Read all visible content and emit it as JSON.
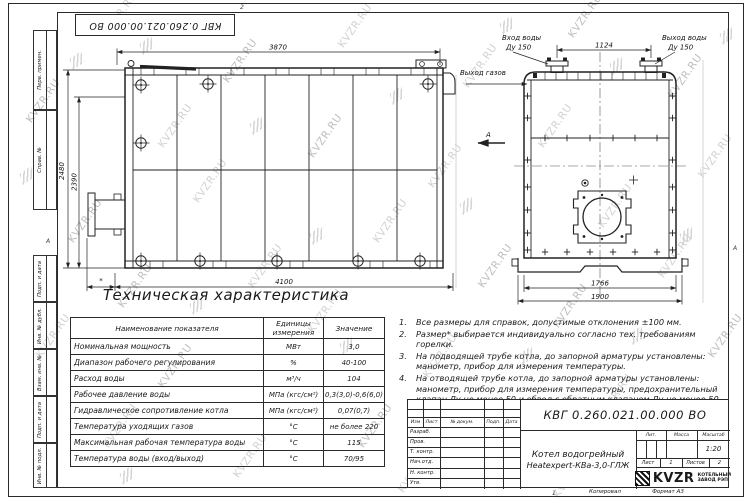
{
  "watermark": "KVZR.RU",
  "doc_number": "КВГ 0.260.021.00.000 ВО",
  "frame": {
    "left_labels": [
      "Перв. примен.",
      "Справ. №",
      "Подп. и дата",
      "Инв. № дубл.",
      "Взам. инв. №",
      "Подп. и дата",
      "Инв. № подл."
    ],
    "top_zone": "2",
    "bottom_zone": "1",
    "right_zone": "А",
    "left_zone": "А"
  },
  "views": {
    "side": {
      "dim_top": "3870",
      "dim_height_outer": "2480",
      "dim_height_inner": "2390",
      "dim_length": "4100",
      "dim_burner": "*",
      "gas_outlet": "Выход газов",
      "view_label": "А"
    },
    "front": {
      "inlet_line1": "Вход воды",
      "inlet_line2": "Ду 150",
      "outlet_line1": "Выход воды",
      "outlet_line2": "Ду 150",
      "flange_spacing": "1124",
      "base_inner": "1766",
      "base_outer": "1900"
    }
  },
  "spec_table": {
    "title": "Техническая характеристика",
    "headers": [
      "Наименование показателя",
      "Единицы измерения",
      "Значение"
    ],
    "rows": [
      [
        "Номинальная мощность",
        "МВт",
        "3,0"
      ],
      [
        "Диапазон рабочего регулирования",
        "%",
        "40-100"
      ],
      [
        "Расход воды",
        "м³/ч",
        "104"
      ],
      [
        "Рабочее давление воды",
        "МПа (кгс/см²)",
        "0,3(3,0)-0,6(6,0)"
      ],
      [
        "Гидравлическое сопротивление котла",
        "МПа (кгс/см²)",
        "0,07(0,7)"
      ],
      [
        "Температура уходящих газов",
        "°С",
        "не более 220"
      ],
      [
        "Максимальная рабочая температура воды",
        "°С",
        "115"
      ],
      [
        "Температура воды (вход/выход)",
        "°С",
        "70/95"
      ]
    ]
  },
  "notes": [
    {
      "num": "1.",
      "text": "Все размеры для справок, допустимые отклонения ±100 мм."
    },
    {
      "num": "2.",
      "text": "Размер* выбирается индивидуально согласно тех. требованиям горелки."
    },
    {
      "num": "3.",
      "text": "На подводящей трубе котла, до запорной арматуры установлены: манометр, прибор для измерения температуры."
    },
    {
      "num": "4.",
      "text": "На отводящей трубе котла, до запорной арматуры установлены: манометр, прибор для измерения температуры, предохранительный клапан Ду не менее 50 и обвод с обратным клапаном Ду не менее 50 мм."
    }
  ],
  "title_block": {
    "product_name_1": "Котел водогрейный",
    "product_name_2": "Heatexpert-КВа-3,0-ГЛЖ",
    "header_cols": [
      "Изм",
      "Лист",
      "№ докум.",
      "Подп.",
      "Дата"
    ],
    "row_labels": [
      "Разраб.",
      "Пров.",
      "Т. контр.",
      "Нач.отд.",
      "Н. контр.",
      "Утв."
    ],
    "lit_label": "Лит.",
    "mass_label": "Масса",
    "scale_label": "Масштаб",
    "scale_value": "1:20",
    "sheet_label": "Лист",
    "sheet_value": "1",
    "sheets_label": "Листов",
    "sheets_value": "2",
    "logo_text": "KVZR",
    "company_line1": "КОТЕЛЬНЫЙ",
    "company_line2": "ЗАВОД РЭП",
    "copied_label": "Копировал",
    "format_label": "Формат А3"
  }
}
